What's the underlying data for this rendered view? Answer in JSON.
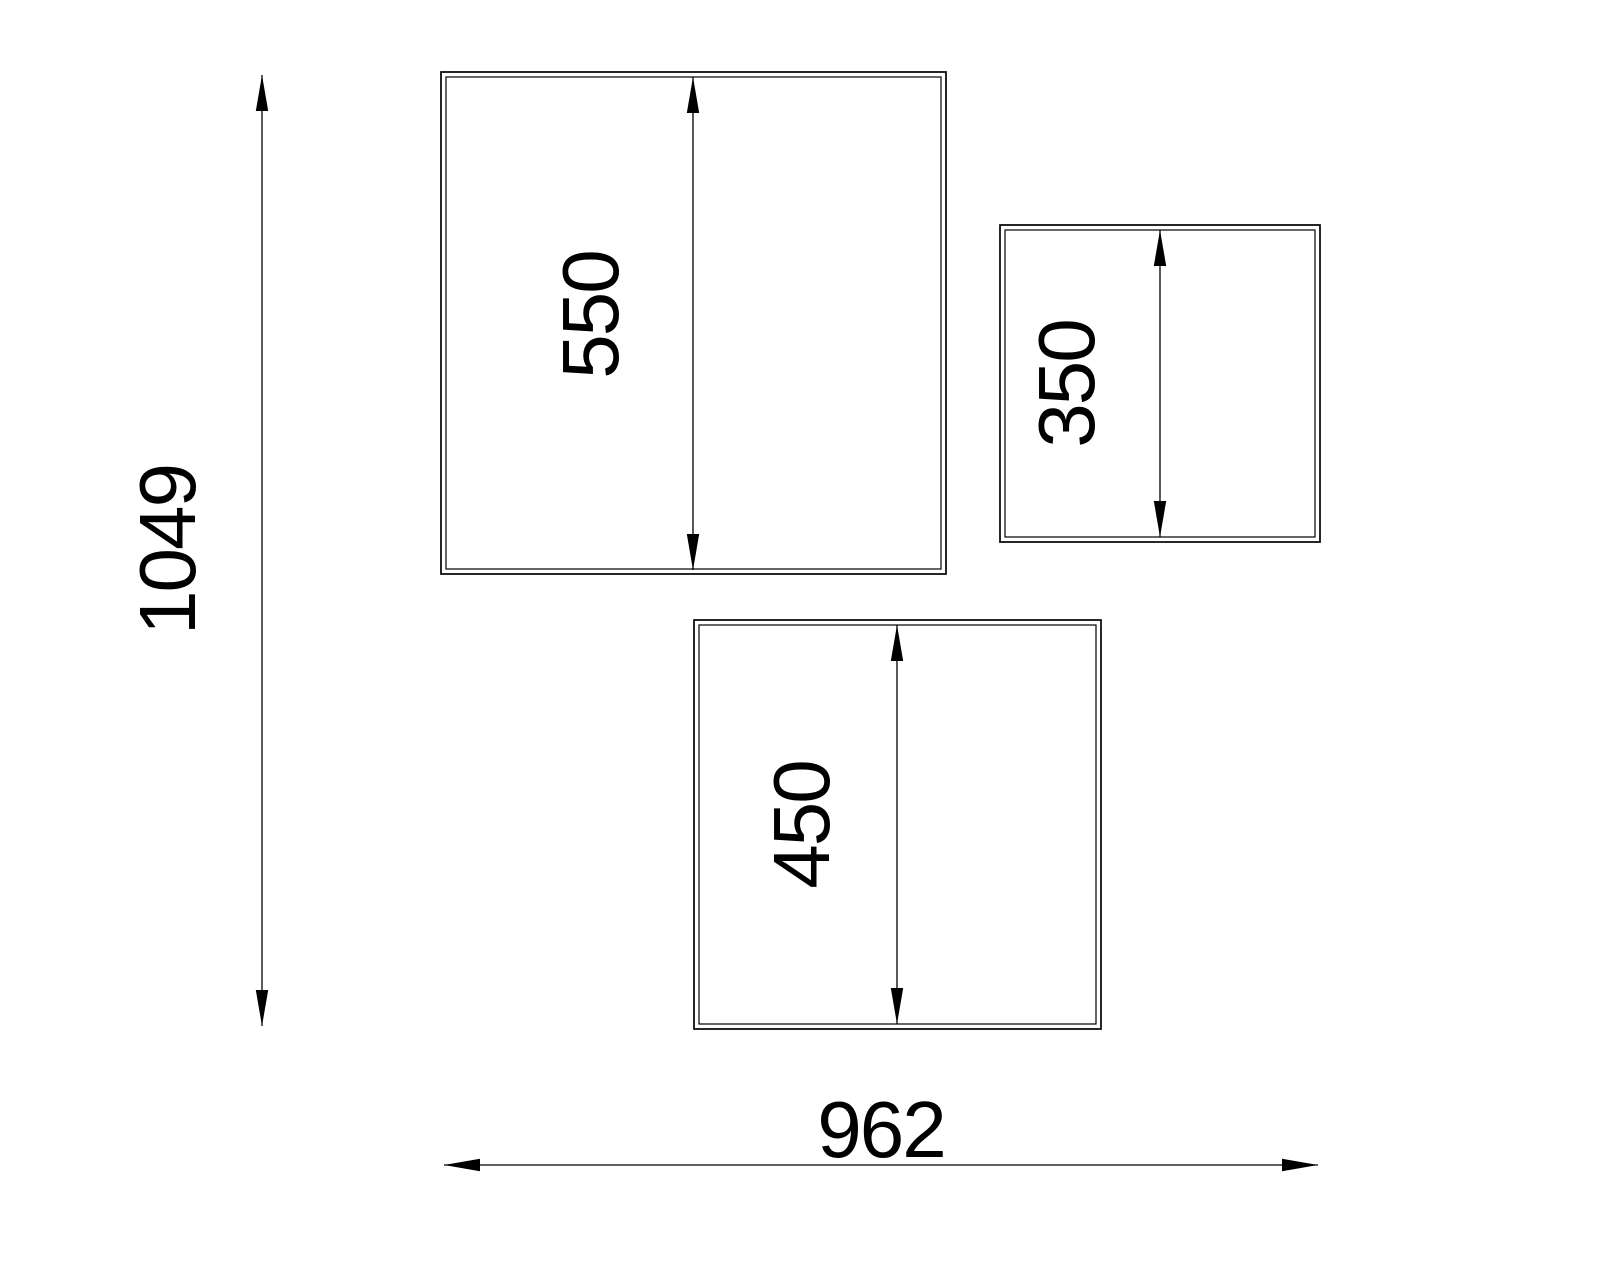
{
  "drawing": {
    "type": "cad-dimension-drawing",
    "colors": {
      "background": "#ffffff",
      "line": "#000000",
      "text": "#000000"
    },
    "dimensions": {
      "panel_large": {
        "label": "550"
      },
      "panel_small": {
        "label": "350"
      },
      "panel_medium": {
        "label": "450"
      },
      "overall_height": {
        "label": "1049"
      },
      "overall_width": {
        "label": "962"
      }
    }
  }
}
